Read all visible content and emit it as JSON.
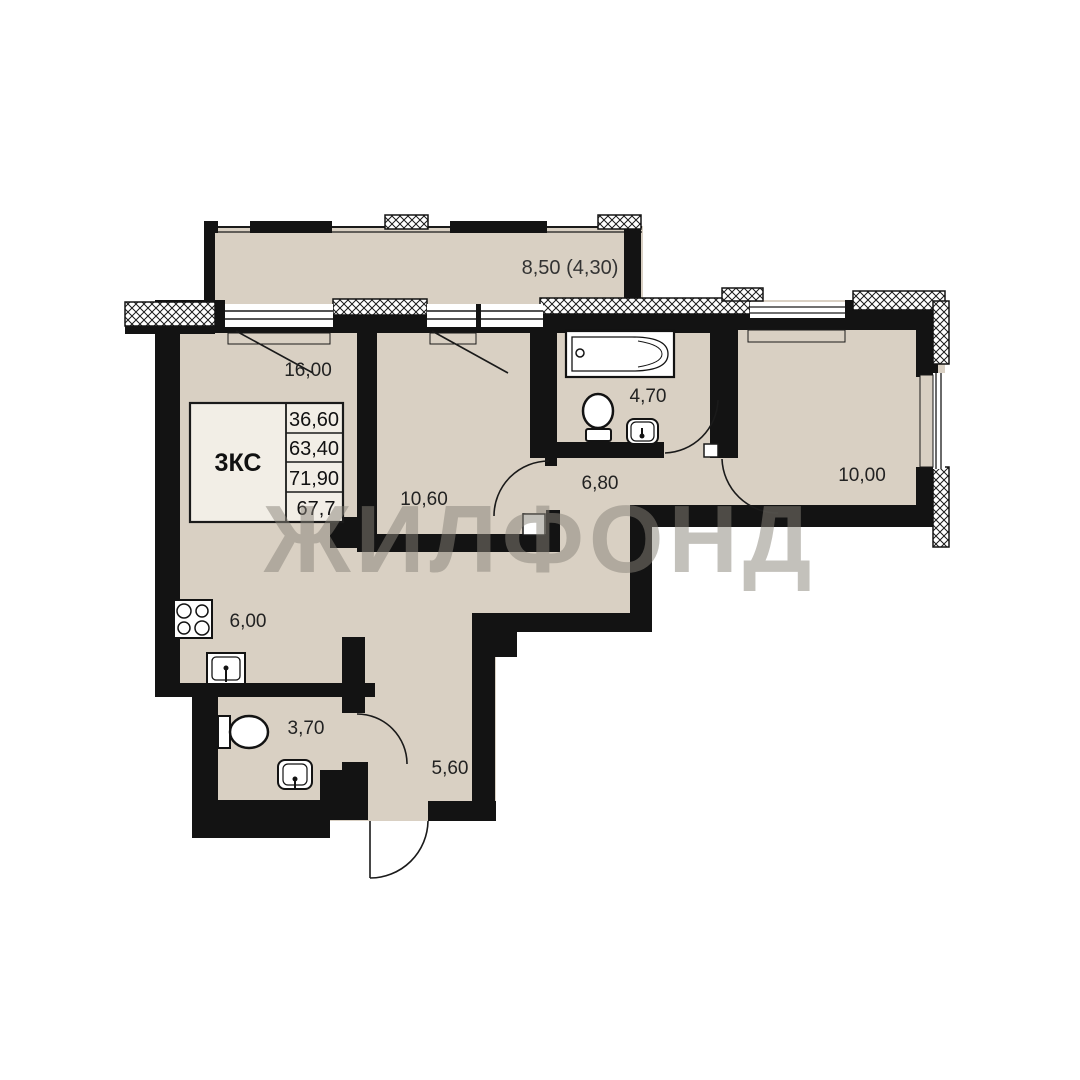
{
  "watermark": {
    "text": "ЖИЛФОНД",
    "color": "#89847a"
  },
  "info_table": {
    "type_label": "3КС",
    "rows": [
      "36,60",
      "63,40",
      "71,90",
      "67,7"
    ]
  },
  "rooms": [
    {
      "id": "living-room",
      "area": "16,00"
    },
    {
      "id": "kitchen",
      "area": "6,00"
    },
    {
      "id": "bedroom-middle",
      "area": "10,60"
    },
    {
      "id": "bathroom-top",
      "area": "4,70"
    },
    {
      "id": "hallway-inner",
      "area": "6,80"
    },
    {
      "id": "bedroom-right",
      "area": "10,00"
    },
    {
      "id": "bathroom-lower",
      "area": "3,70"
    },
    {
      "id": "hallway-entrance",
      "area": "5,60"
    },
    {
      "id": "balcony",
      "area": "8,50 (4,30)"
    }
  ],
  "colors": {
    "background": "#ffffff",
    "floor": "#d9d0c3",
    "wall": "#131313",
    "table_fill": "#f2eee6",
    "watermark": "#89847a"
  }
}
